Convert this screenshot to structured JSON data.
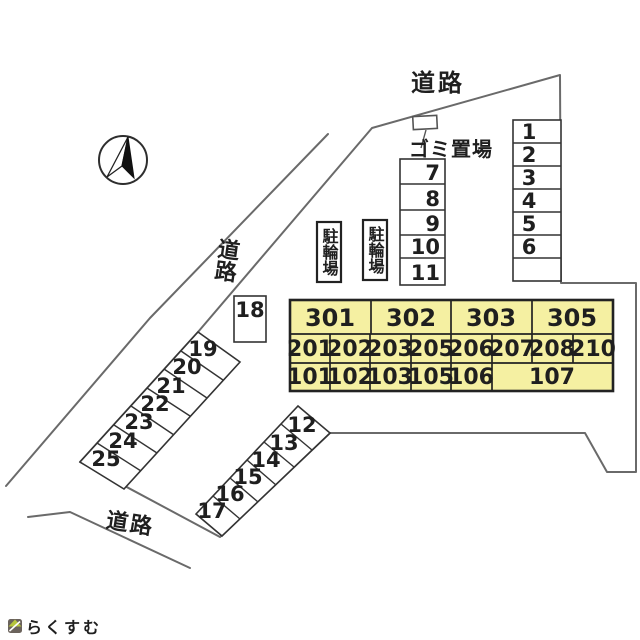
{
  "labels": {
    "road_top": "道路",
    "road_left": "道路",
    "road_bottom": "道路",
    "garbage_area": "ゴミ置場",
    "bicycle_parking_left": "駐輪場",
    "bicycle_parking_right": "駐輪場"
  },
  "parking": {
    "right_column": [
      "1",
      "2",
      "3",
      "4",
      "5",
      "6"
    ],
    "middle_column": [
      "7",
      "8",
      "9",
      "10",
      "11"
    ],
    "box": "18",
    "upper_strip": [
      "19",
      "20",
      "21",
      "22",
      "23",
      "24",
      "25"
    ],
    "lower_strip": [
      "12",
      "13",
      "14",
      "15",
      "16",
      "17"
    ]
  },
  "building": {
    "floor_3": [
      "301",
      "302",
      "303",
      "305"
    ],
    "floor_2": [
      "201",
      "202",
      "203",
      "205",
      "206",
      "207",
      "208",
      "210"
    ],
    "floor_1": [
      "101",
      "102",
      "103",
      "105",
      "106",
      "107"
    ]
  },
  "watermark": {
    "text": "らくすむ"
  },
  "colors": {
    "building_fill": "#f5f0a2",
    "boundary_line": "#6a6a6a",
    "cell_line": "#333333",
    "text": "#1f1f1f",
    "logo_green": "#b7c63c",
    "logo_dark": "#6b635c",
    "watermark_text": "#9a9089"
  }
}
